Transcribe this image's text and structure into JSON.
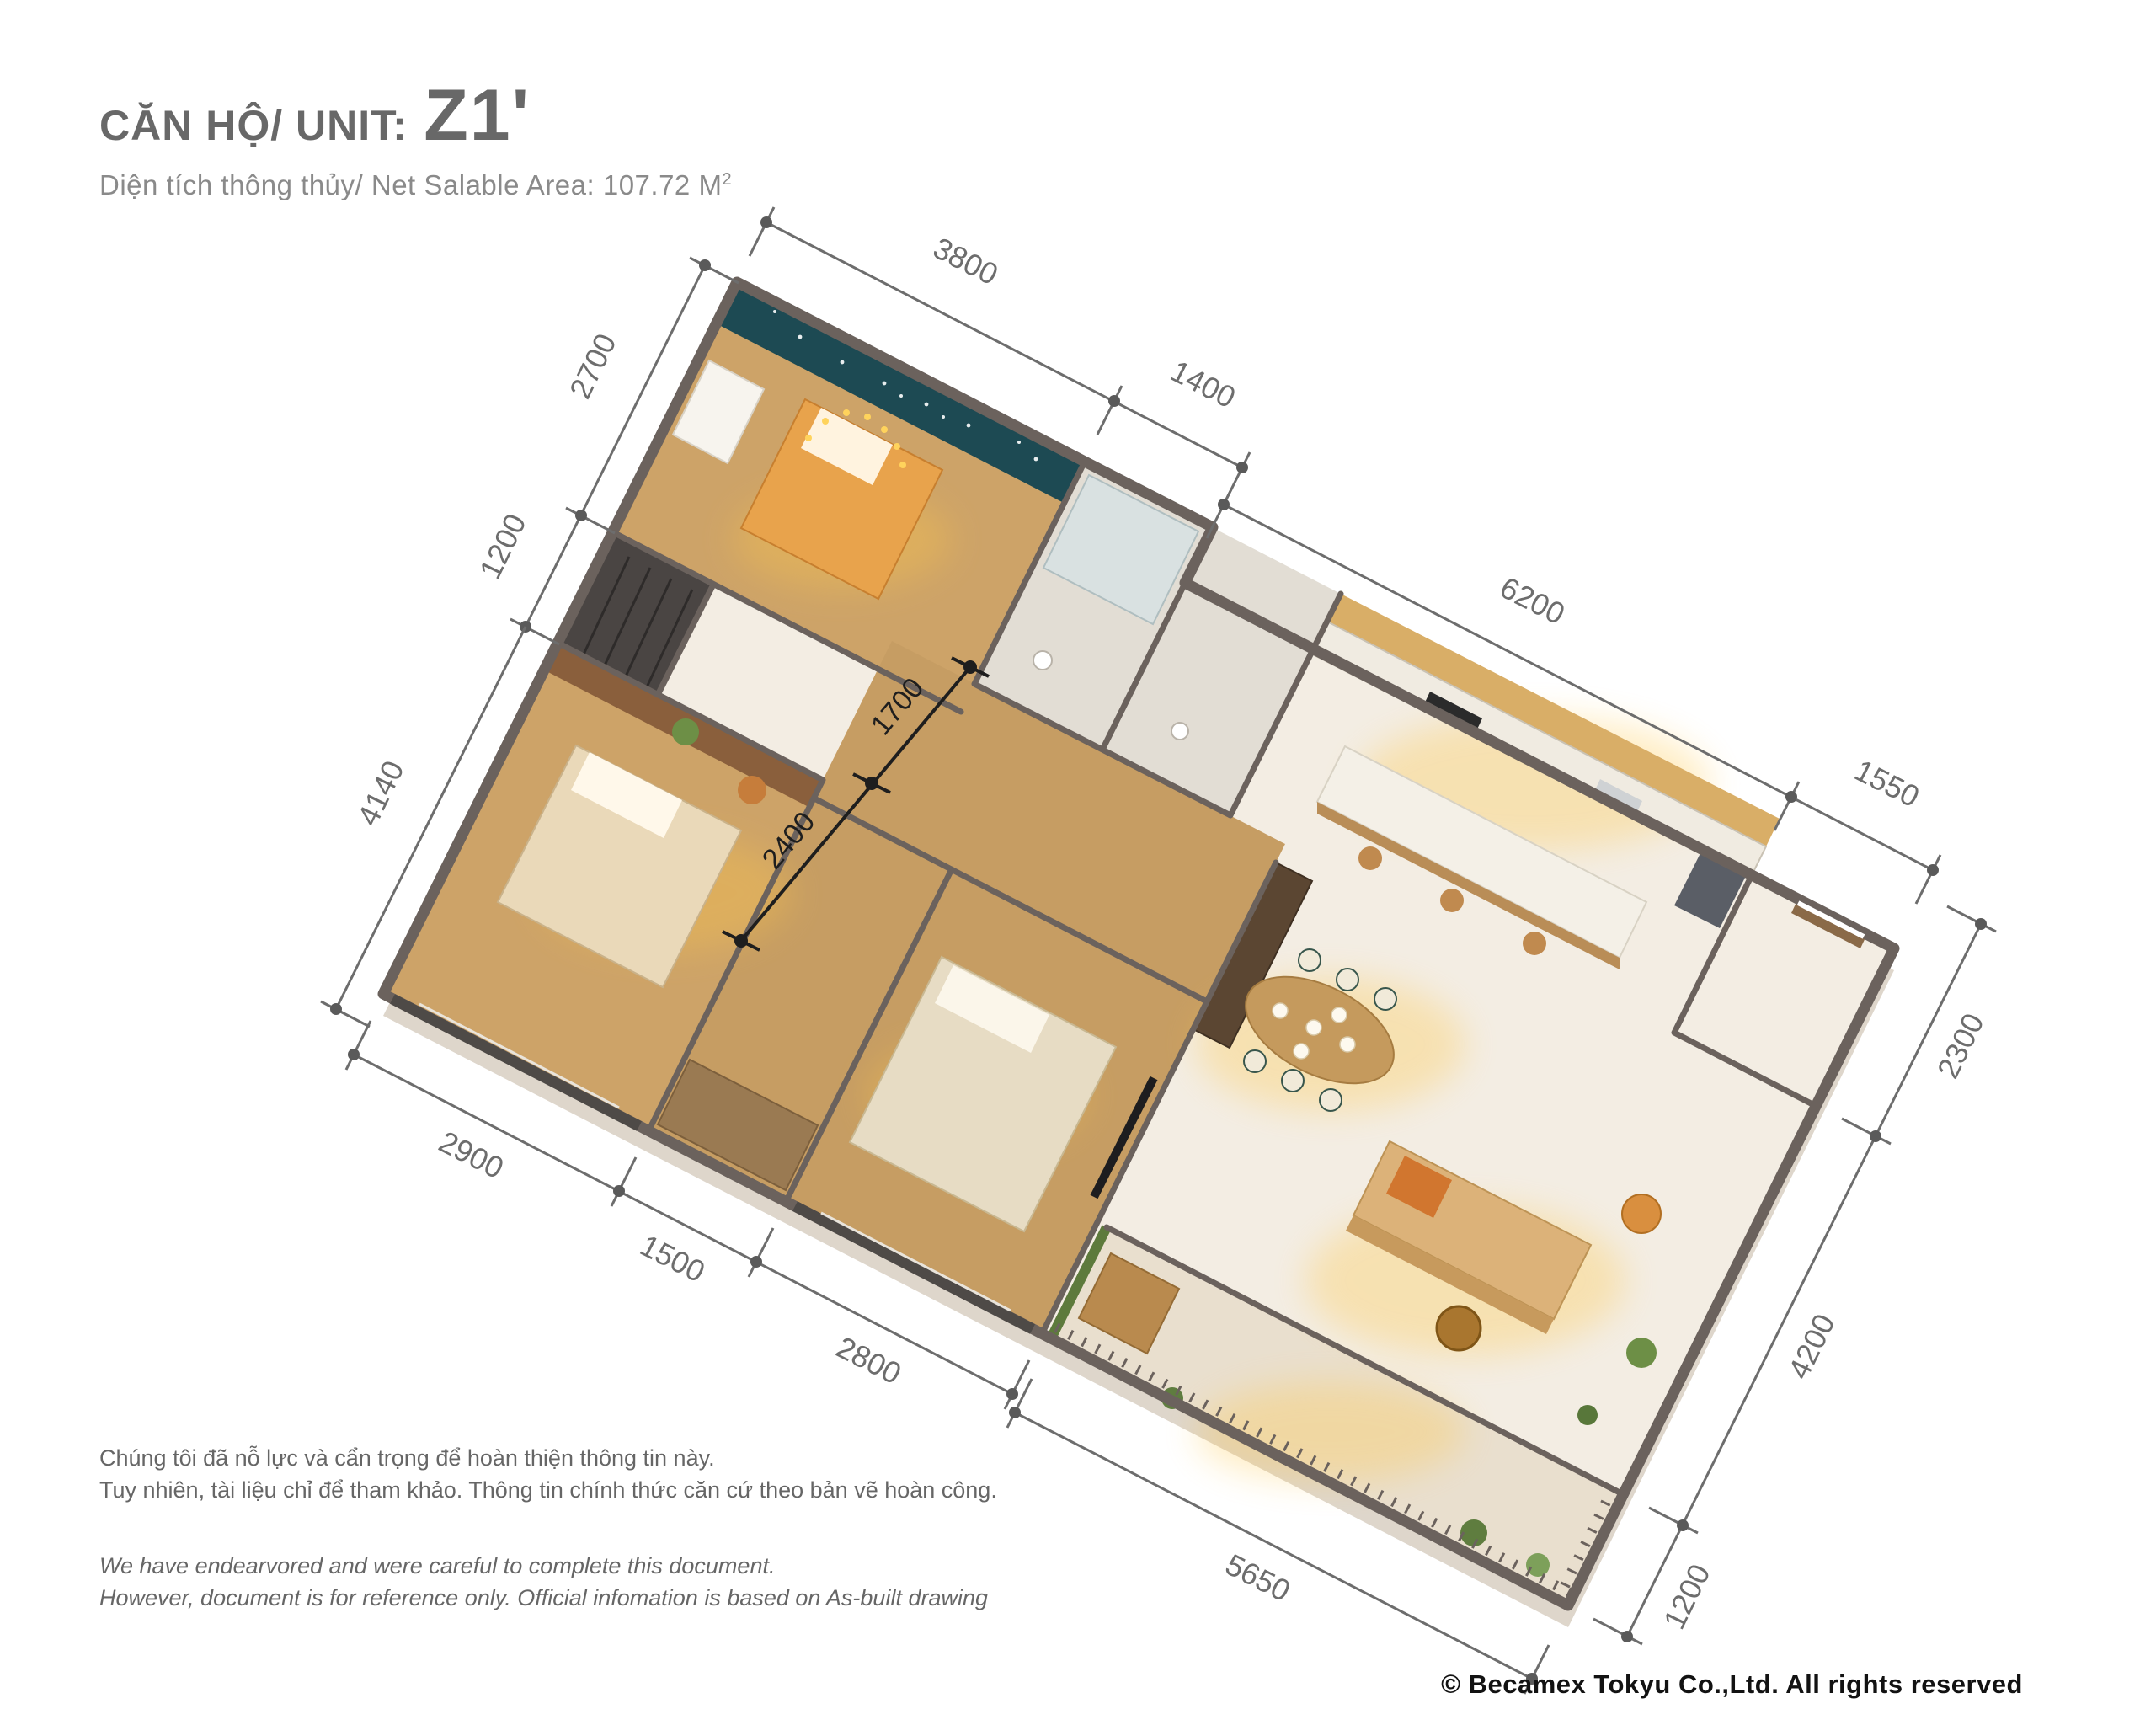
{
  "header": {
    "title": "CĂN HỘ/ UNIT:",
    "unit_code": "Z1'",
    "subtitle": "Diện tích thông thủy/ Net Salable Area: 107.72 M",
    "area_unit_superscript": "2"
  },
  "plan": {
    "colors": {
      "wall": "#6b625d",
      "floor": "#f3ede3",
      "wood_floor": "#cda368",
      "tile_floor": "#e2ddd4",
      "accent_wall_teal": "#1d4a53",
      "kitchen_cabinet": "#d9ae67",
      "warm_glow": "#ffc84a",
      "dimension_line": "#6d6d6d",
      "interior_dimension": "#1e1e1e"
    },
    "dimensions": {
      "top_right_edge": [
        "3800",
        "1400"
      ],
      "kitchen_edge": [
        "6200",
        "1550"
      ],
      "top_left_edge": [
        "2700",
        "1200"
      ],
      "west_edge": [
        "4140"
      ],
      "east_edge": [
        "2300",
        "4200",
        "1200"
      ],
      "southwest_edge": [
        "2900",
        "1500",
        "2800"
      ],
      "south_edge": [
        "5650"
      ],
      "interior": [
        "1700",
        "2400"
      ]
    }
  },
  "footer": {
    "disclaimer_vi_1": "Chúng tôi đã nỗ lực và cẩn trọng để hoàn thiện thông tin này.",
    "disclaimer_vi_2": "Tuy nhiên, tài liệu chỉ để tham khảo. Thông tin chính thức căn cứ theo bản vẽ hoàn công.",
    "disclaimer_en_1": "We have endearvored and were careful to complete this document.",
    "disclaimer_en_2": "However, document is for reference only. Official infomation is based on As-built drawing",
    "copyright": "© Becamex Tokyu Co.,Ltd. All rights reserved"
  }
}
